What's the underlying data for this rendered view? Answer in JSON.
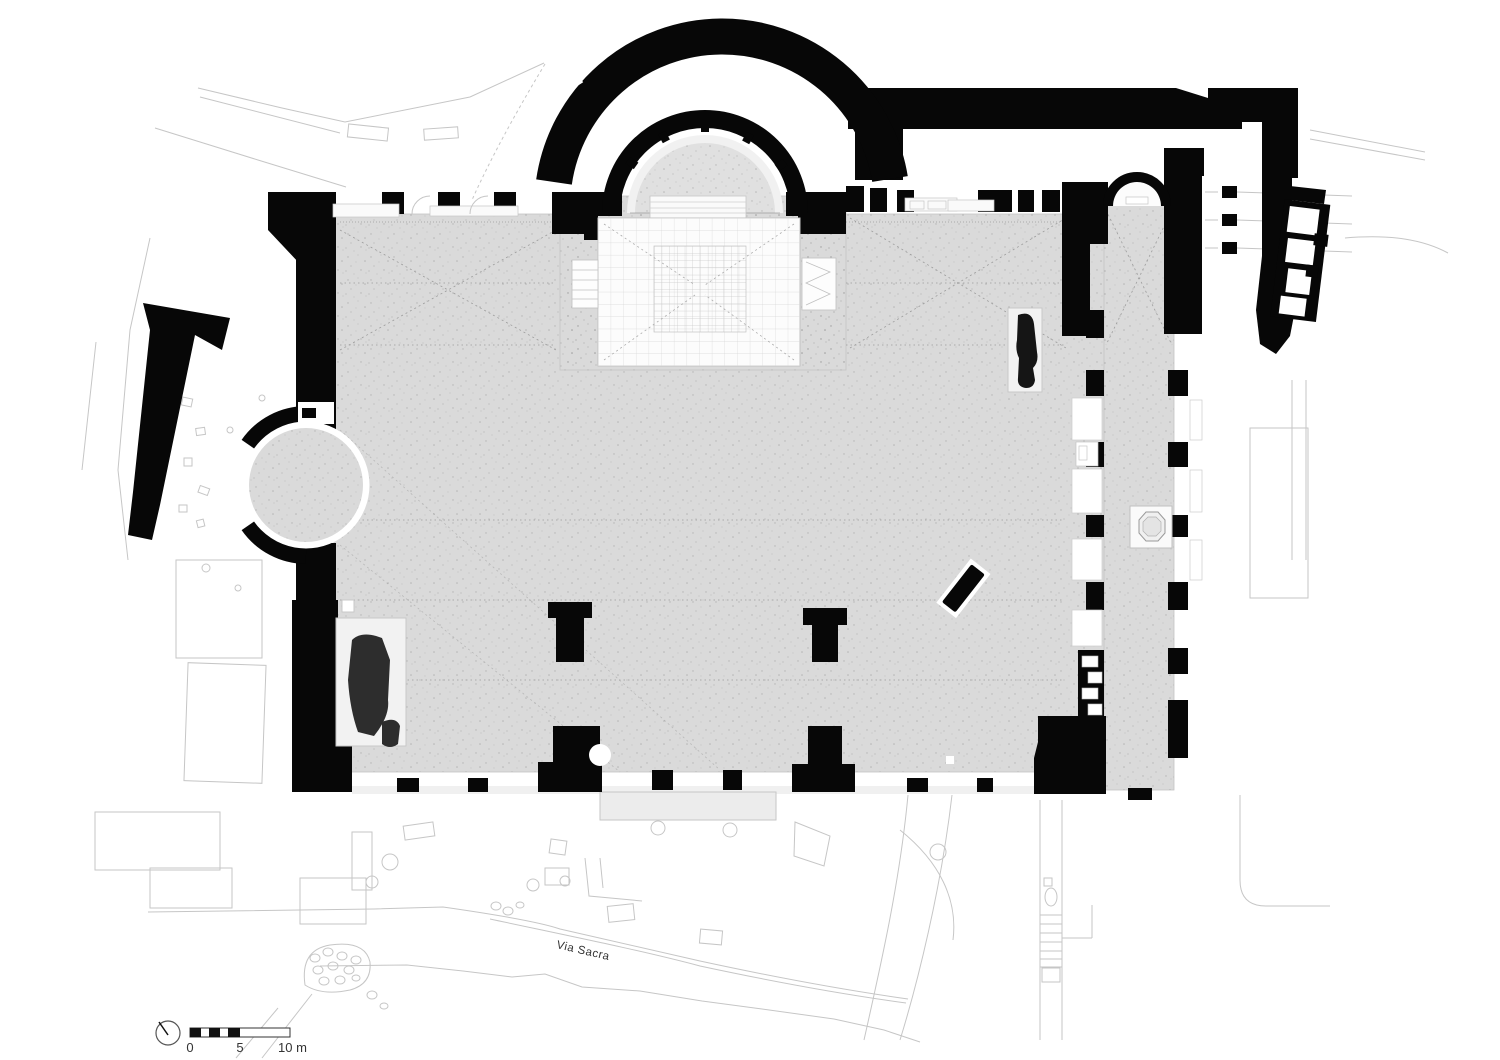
{
  "drawing": {
    "road_label": "Via Sacra",
    "scale_bar": {
      "label_0": "0",
      "label_5": "5",
      "label_10": "10 m"
    },
    "icons": {
      "north_indicator": "north-arrow-icon",
      "scale": "scale-bar"
    }
  },
  "colors": {
    "background": "#ffffff",
    "wall": "#070707",
    "floor": "#dadada",
    "apse_floor": "#e0e0e0",
    "room_white": "#fcfcfc",
    "remains": "#2d2d2d",
    "context_line": "#c6c6c6",
    "guide_line": "#9c9c9c",
    "text": "#333333"
  }
}
